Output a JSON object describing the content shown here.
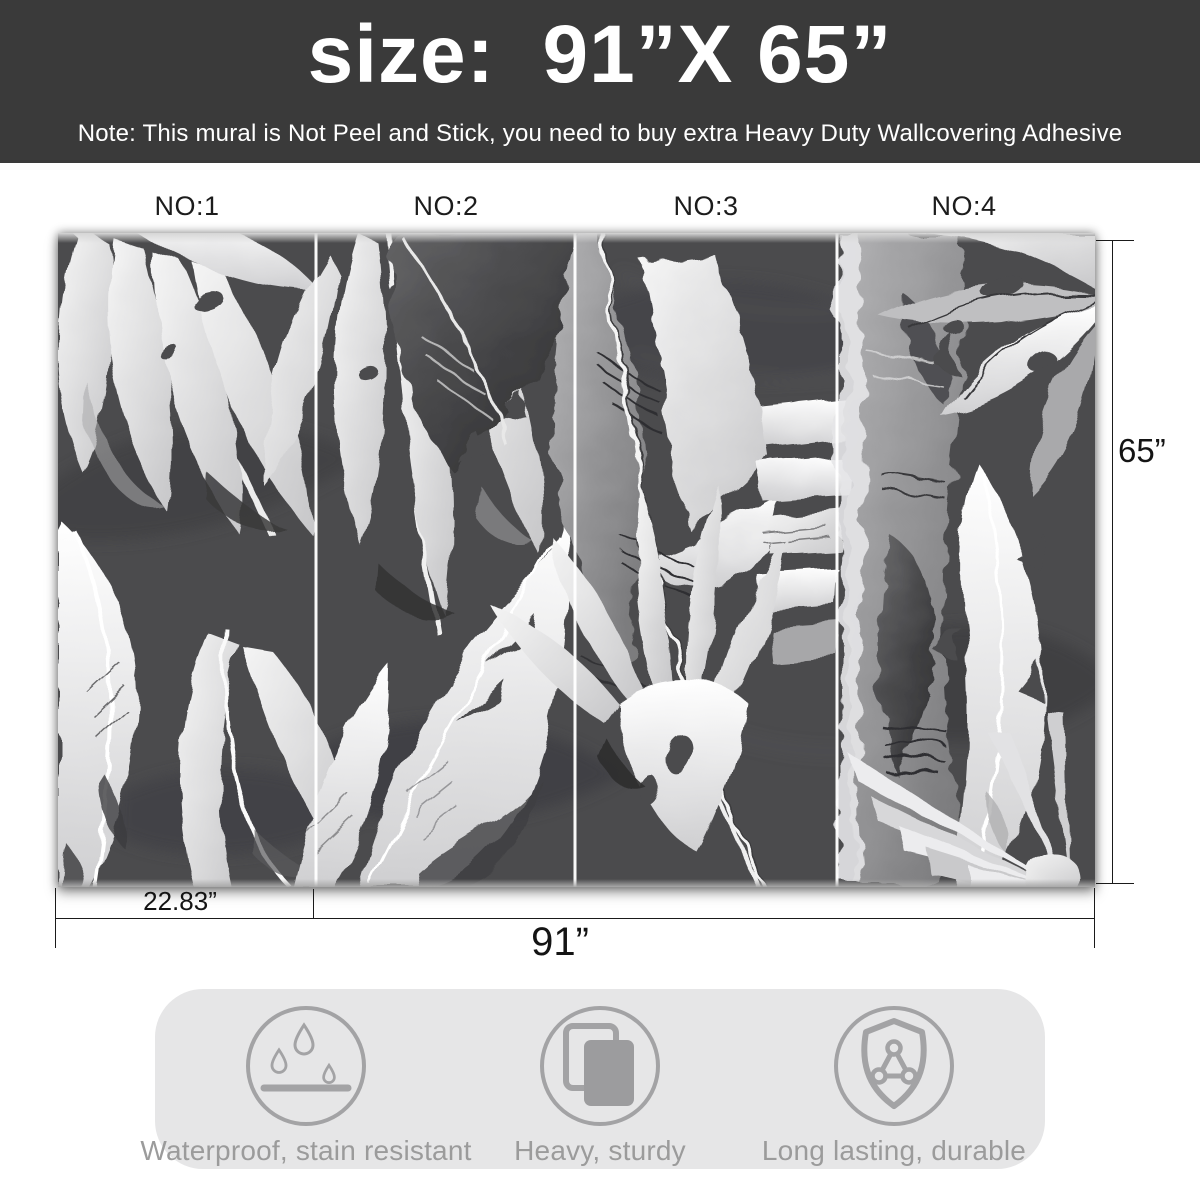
{
  "header": {
    "title": "size:  91”X 65”",
    "note": "Note: This mural is Not Peel and Stick, you need to buy extra Heavy Duty Wallcovering Adhesive"
  },
  "panels": [
    {
      "label": "NO:1"
    },
    {
      "label": "NO:2"
    },
    {
      "label": "NO:3"
    },
    {
      "label": "NO:4"
    }
  ],
  "mural": {
    "description": "black and white watercolor tropical leaf mural, 4 panels",
    "panel_count": 4
  },
  "dimensions": {
    "panel_width": "22.83”",
    "total_width": "91”",
    "height": "65”"
  },
  "features": [
    {
      "icon": "waterproof-icon",
      "label": "Waterproof, stain resistant"
    },
    {
      "icon": "heavy-icon",
      "label": "Heavy, sturdy"
    },
    {
      "icon": "shield-icon",
      "label": "Long lasting, durable"
    }
  ],
  "colors": {
    "banner_bg": "#3a3a3a",
    "banner_text": "#ffffff",
    "mural_bg": "#4b4b4d",
    "panel_divider": "#ffffff",
    "dimension_line": "#1a1a1a",
    "feature_bg": "#e6e6e7",
    "feature_fg": "#a3a3a5",
    "feature_text": "#9b9b9b"
  }
}
